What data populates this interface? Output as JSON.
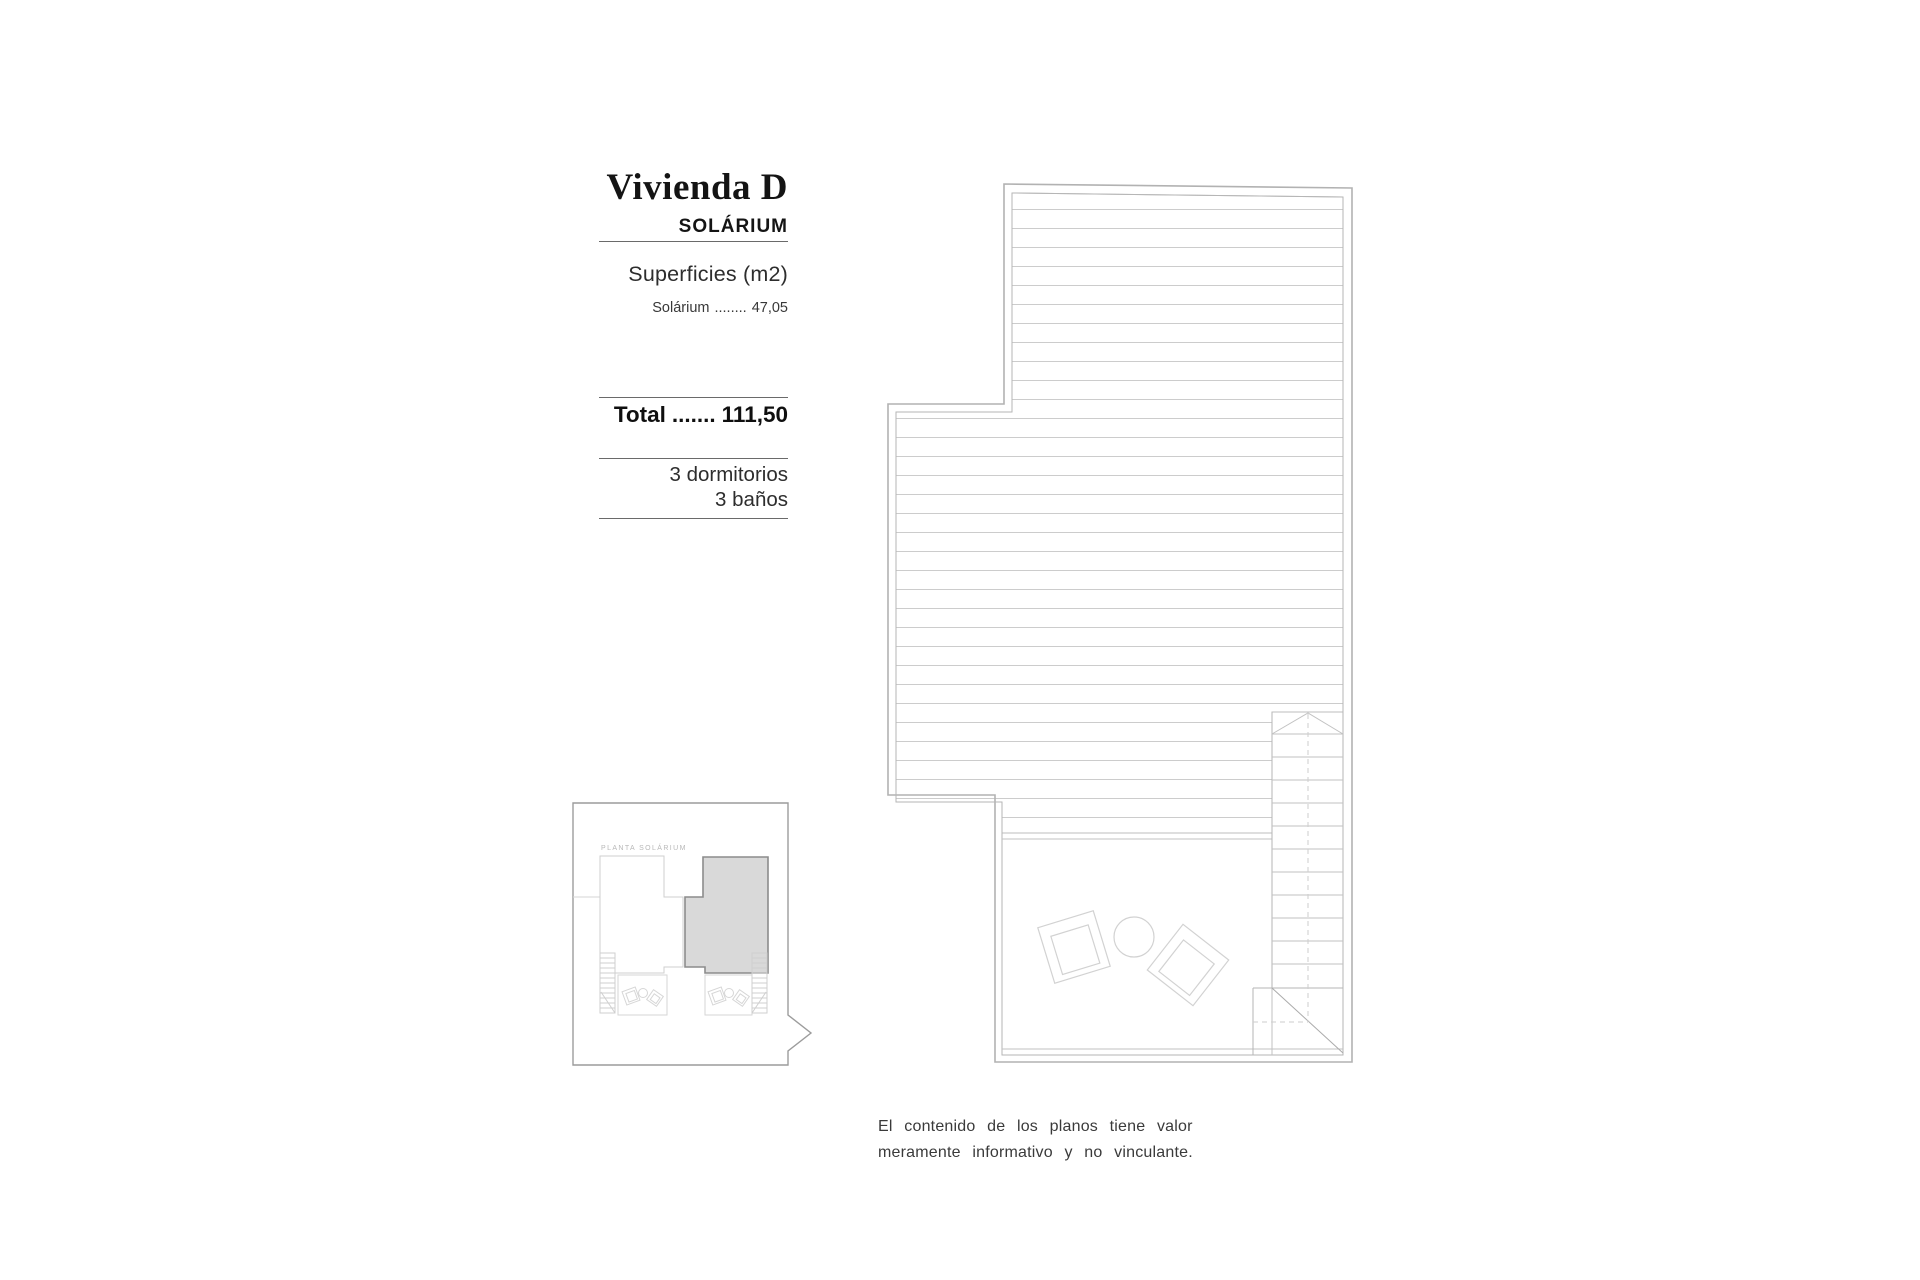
{
  "info_panel": {
    "title": "Vivienda D",
    "subtitle": "SOLÁRIUM",
    "surfaces_heading": "Superficies (m2)",
    "surface_rows": [
      {
        "label": "Solárium",
        "dots": "........",
        "value": "47,05"
      }
    ],
    "total_label": "Total",
    "total_dots": ".......",
    "total_value": "111,50",
    "features": [
      "3 dormitorios",
      "3 baños"
    ]
  },
  "key_plan": {
    "label": "PLANTA SOLÁRIUM"
  },
  "disclaimer": {
    "line1": "El contenido de los planos tiene valor",
    "line2": "meramente informativo y no vinculante."
  },
  "colors": {
    "wall_line": "#b2b2b2",
    "hatch_line": "#cccccc",
    "furniture_line": "#d2d2d2",
    "highlight_fill": "#d9d9d9",
    "highlight_stroke": "#8c8c8c",
    "keyplan_border": "#9c9c9c",
    "text": "#1a1a1a"
  }
}
